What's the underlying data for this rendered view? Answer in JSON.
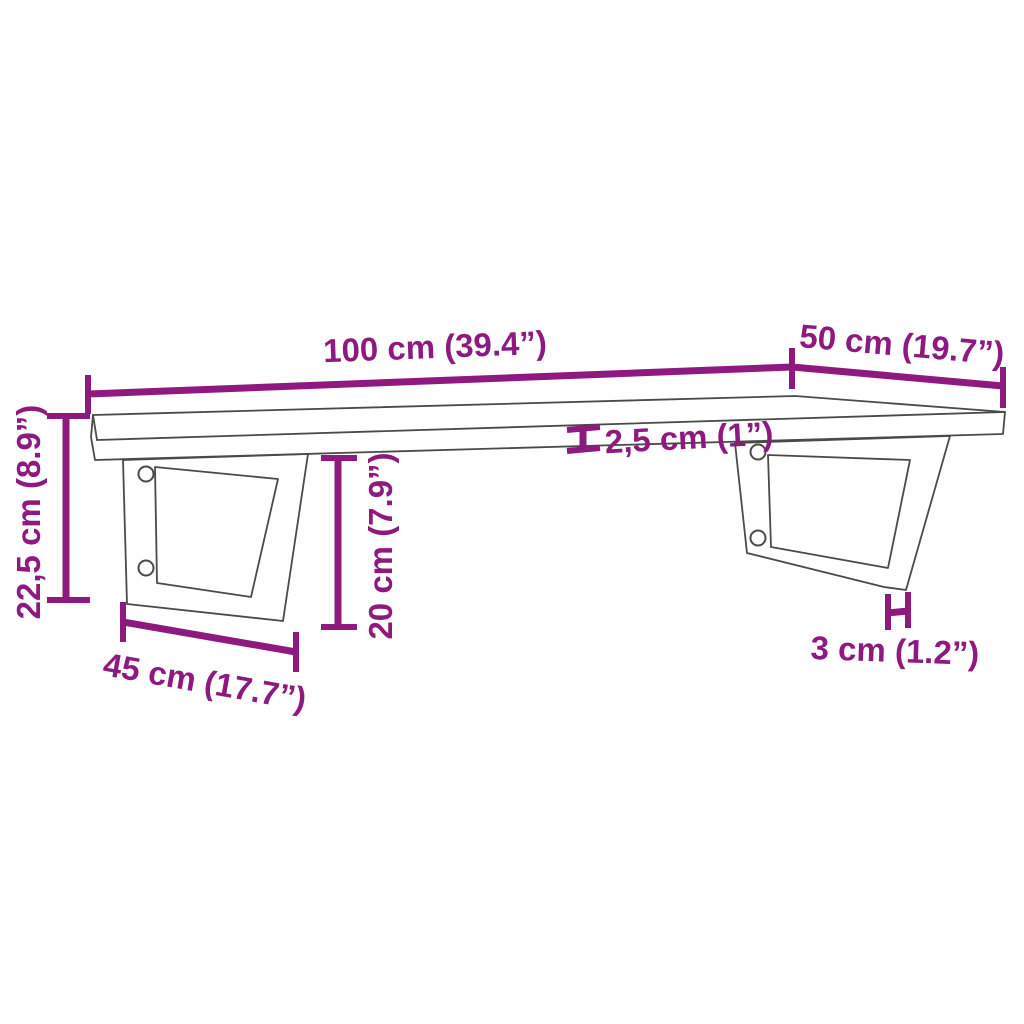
{
  "diagram": {
    "background_color": "#ffffff",
    "outline_color": "#4a4a48",
    "dimension_color": "#8e1a80",
    "labels": {
      "width": "100 cm (39.4”)",
      "depth": "50 cm (19.7”)",
      "thickness": "2,5 cm (1”)",
      "total_height": "22,5 cm (8.9”)",
      "bracket_height": "20 cm (7.9”)",
      "bracket_width": "45 cm (17.7”)",
      "leg_thickness": "3 cm (1.2”)"
    }
  }
}
